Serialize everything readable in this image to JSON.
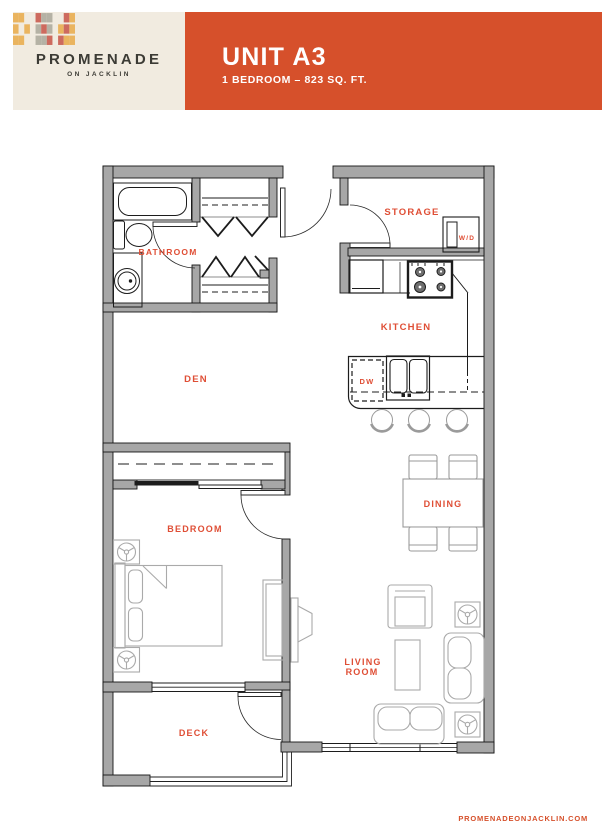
{
  "brand": {
    "logo_text": "PROMENADE",
    "logo_tagline": "ON JACKLIN"
  },
  "banner": {
    "title": "UNIT A3",
    "subtitle": "1 BEDROOM – 823 SQ. FT."
  },
  "plan": {
    "labels": {
      "bathroom": "BATHROOM",
      "storage": "STORAGE",
      "wd": "W/D",
      "kitchen": "KITCHEN",
      "dw": "DW",
      "den": "DEN",
      "bedroom": "BEDROOM",
      "dining": "DINING",
      "living1": "LIVING",
      "living2": "ROOM",
      "deck": "DECK"
    }
  },
  "footer": {
    "website": "PROMENADEONJACKLIN.COM"
  },
  "colors": {
    "banner_orange": "#d6502b",
    "label_orange": "#df4e35",
    "logo_cream": "#f1ebe0",
    "logo_dark": "#3c3b35",
    "logo_yellow": "#eab45f",
    "logo_red": "#cd6a5e",
    "logo_gray": "#b5b2a5",
    "wall_gray": "#a7a7a7"
  }
}
